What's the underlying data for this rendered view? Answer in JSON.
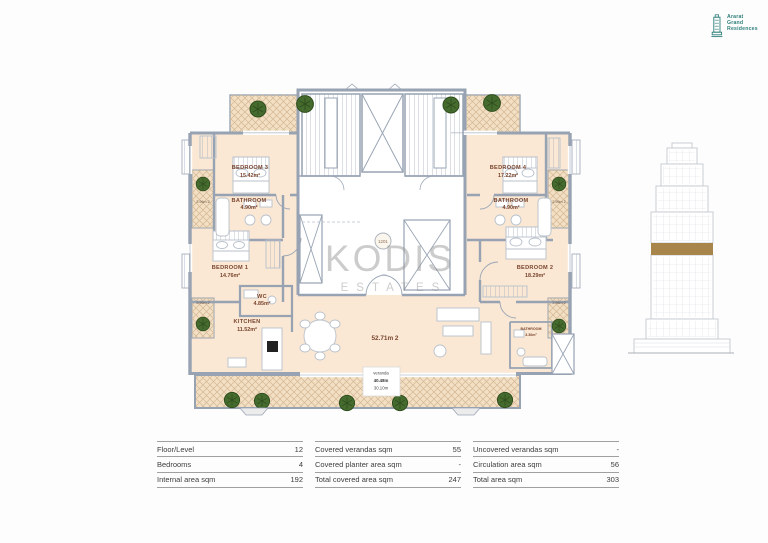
{
  "logo": {
    "lines": [
      "Ararat",
      "Grand",
      "Residences"
    ],
    "color": "#2f7f7a"
  },
  "watermark": {
    "title": "KODIS",
    "subtitle": "ESTATES"
  },
  "floorplan": {
    "unit_number": "1201",
    "rooms": {
      "bedroom3": {
        "name": "BEDROOM 3",
        "area": "15.42m²"
      },
      "bedroom4": {
        "name": "BEDROOM 4",
        "area": "17.22m²"
      },
      "bathroom3": {
        "name": "BATHROOM",
        "area": "4.90m²"
      },
      "bathroom4": {
        "name": "BATHROOM",
        "area": "4.90m²"
      },
      "bedroom1": {
        "name": "BEDROOM 1",
        "area": "14.76m²"
      },
      "bedroom2": {
        "name": "BEDROOM 2",
        "area": "18.29m²"
      },
      "wc": {
        "name": "WC",
        "area": "4.85m²"
      },
      "kitchen": {
        "name": "KITCHEN",
        "area": "11.52m²"
      },
      "bathroom_small": {
        "name": "BATHROOM",
        "area": "3.36m²"
      },
      "living": {
        "area": "52.71m 2"
      }
    },
    "planter_label": "2.96m 2",
    "veranda_label": {
      "line1": "veranda",
      "line2": "40.48m",
      "line3": "30.10m"
    },
    "colors": {
      "floor": "#fae8d4",
      "hatch": "#f3dfc4",
      "wall": "#97a2b2",
      "plant": "#456b2f",
      "label": "#7a452e",
      "highlight_band": "#a8854a"
    }
  },
  "summary_table": {
    "columns": [
      {
        "rows": [
          {
            "label": "Floor/Level",
            "value": "12"
          },
          {
            "label": "Bedrooms",
            "value": "4"
          },
          {
            "label": "Internal area sqm",
            "value": "192"
          }
        ]
      },
      {
        "rows": [
          {
            "label": "Covered verandas sqm",
            "value": "55"
          },
          {
            "label": "Covered planter area sqm",
            "value": "-"
          },
          {
            "label": "Total covered area sqm",
            "value": "247"
          }
        ]
      },
      {
        "rows": [
          {
            "label": "Uncovered verandas sqm",
            "value": "-"
          },
          {
            "label": "Circulation area sqm",
            "value": "56"
          },
          {
            "label": "Total area sqm",
            "value": "303"
          }
        ]
      }
    ]
  }
}
